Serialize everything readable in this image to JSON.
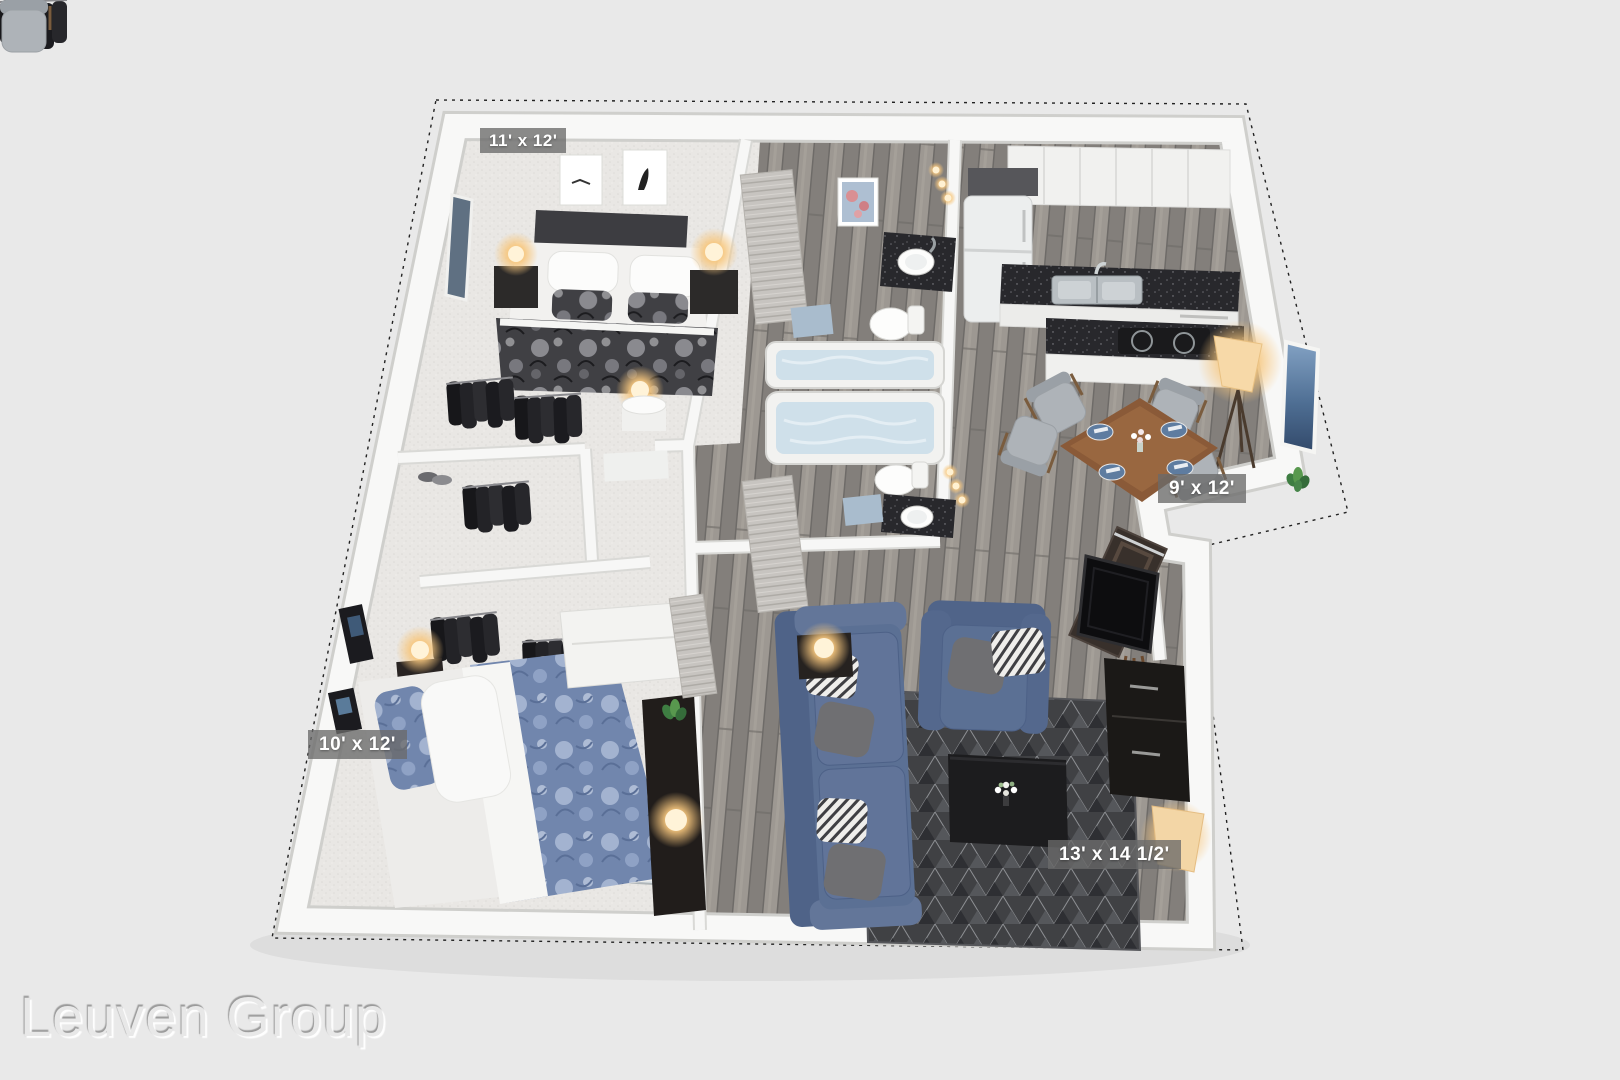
{
  "scene": {
    "type": "3d-floor-plan",
    "view": "dollhouse-overhead"
  },
  "watermark": {
    "text": "Leuven Group"
  },
  "rooms": [
    {
      "id": "bedroom-1",
      "label": "11' x 12'"
    },
    {
      "id": "dining-area",
      "label": "9' x 12'"
    },
    {
      "id": "bedroom-2",
      "label": "10' x 12'"
    },
    {
      "id": "living-room",
      "label": "13' x 14 1/2'"
    }
  ],
  "palette": {
    "background": "#e9e9e9",
    "wall": "#f8f8f7",
    "wall_shadow": "#d8d8d5",
    "wood_floor": "#8e8a85",
    "carpet": "#e9e7e4",
    "counter_dark": "#28282c",
    "sofa_blue": "#5b7094",
    "duvet_blue": "#7186ad",
    "duvet_dark": "#404044",
    "dining_table_wood": "#8a5a38",
    "rug_dark": "#404144",
    "tub_water": "#cfe0ea",
    "lamp_glow": "#f6c27b",
    "label_bg": "rgba(106,106,106,0.78)",
    "label_text": "#ffffff"
  }
}
